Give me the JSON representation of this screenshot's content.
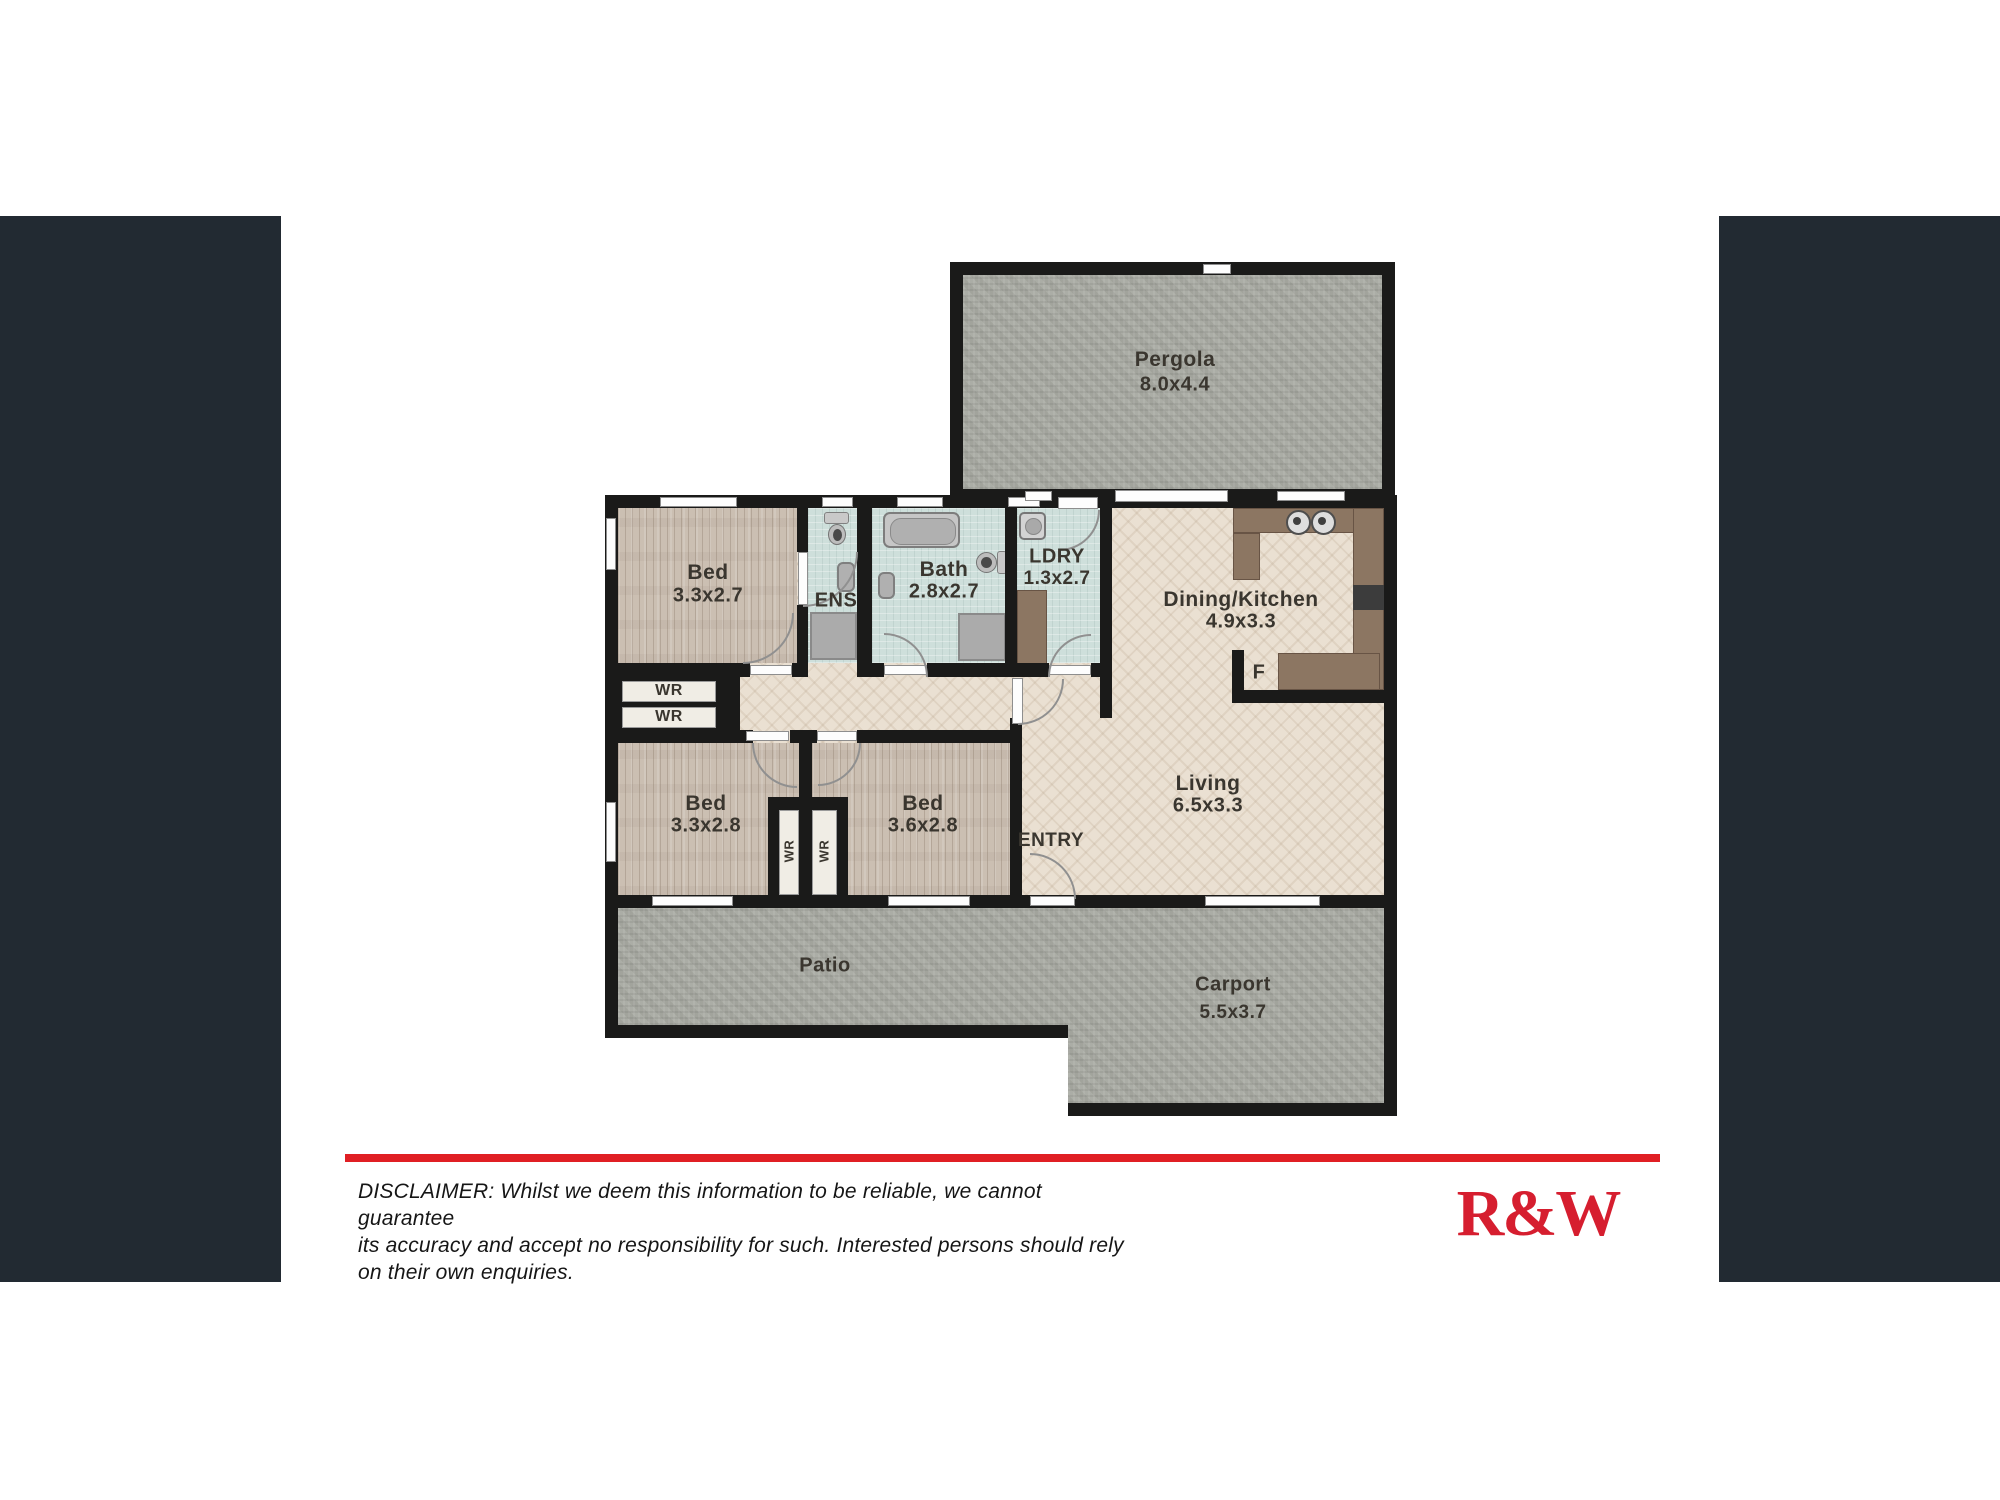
{
  "page": {
    "background": "#ffffff",
    "side_panel_color": "#222A32"
  },
  "branding": {
    "logo_text": "R&W",
    "logo_color": "#D61E2F",
    "divider_color": "#E01F24"
  },
  "disclaimer": {
    "lines": [
      "DISCLAIMER: Whilst we deem this information to be reliable, we cannot guarantee",
      "its accuracy and accept no responsibility for such. Interested persons should rely",
      "on their own enquiries."
    ]
  },
  "floorplan": {
    "colors": {
      "wall": "#1A1A19",
      "outdoor_gray": "#A8AAA2",
      "bedroom_wood": "#CBBFB2",
      "living_herringbone": "#EAE0D2",
      "wet_area_tile": "#CEDFDB",
      "kitchen_counter": "#8C7662"
    },
    "rooms": {
      "pergola": {
        "name": "Pergola",
        "dims": "8.0x4.4"
      },
      "bed1": {
        "name": "Bed",
        "dims": "3.3x2.7"
      },
      "ens": {
        "name": "ENS"
      },
      "bath": {
        "name": "Bath",
        "dims": "2.8x2.7"
      },
      "ldry": {
        "name": "LDRY",
        "dims": "1.3x2.7"
      },
      "dining_kitchen": {
        "name": "Dining/Kitchen",
        "dims": "4.9x3.3"
      },
      "bed2": {
        "name": "Bed",
        "dims": "3.3x2.8"
      },
      "bed3": {
        "name": "Bed",
        "dims": "3.6x2.8"
      },
      "living": {
        "name": "Living",
        "dims": "6.5x3.3"
      },
      "patio": {
        "name": "Patio"
      },
      "carport": {
        "name": "Carport",
        "dims": "5.5x3.7"
      }
    },
    "labels": {
      "entry": "ENTRY",
      "fridge": "F",
      "wardrobe": "WR"
    }
  }
}
